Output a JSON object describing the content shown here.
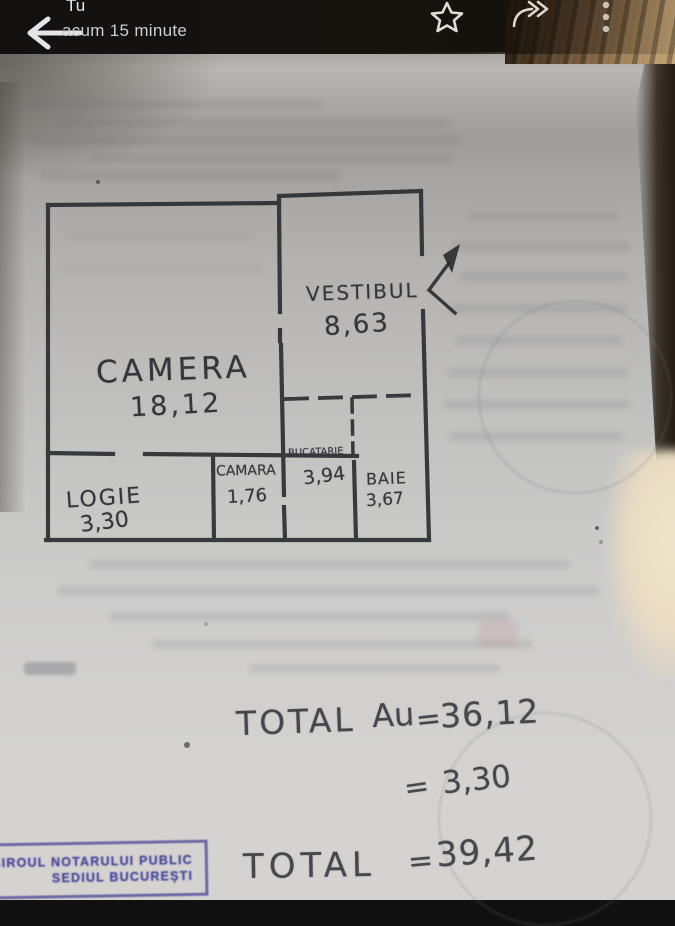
{
  "app_bar": {
    "title": "Tu",
    "subtitle": "acum 15 minute",
    "icons": {
      "back": "back-arrow",
      "star": "star-outline",
      "forward": "forward-share",
      "menu": "overflow-menu"
    }
  },
  "photo": {
    "floor_plan": {
      "rooms": [
        {
          "name": "CAMERA",
          "area": "18,12"
        },
        {
          "name": "VESTIBUL",
          "area": "8,63"
        },
        {
          "name": "LOGIE",
          "area": "3,30"
        },
        {
          "name": "CAMARA",
          "area": "1,76"
        },
        {
          "name": "BUCATARIE",
          "area": "3,94"
        },
        {
          "name": "BAIE",
          "area": "3,67"
        }
      ]
    },
    "totals": {
      "row1": {
        "label": "TOTAL",
        "symbol": "Au",
        "eq": "=",
        "value": "36,12"
      },
      "row2": {
        "eq": "=",
        "value": "3,30"
      },
      "row3": {
        "label": "TOTAL",
        "eq": "=",
        "value": "39,42"
      }
    },
    "stamp": {
      "line1": "BIROUL NOTARULUI PUBLIC",
      "line2": "SEDIUL BUCUREȘTI"
    }
  },
  "colors": {
    "pencil": "#35363a",
    "stamp_ink": "#43439b",
    "app_bar_bg": "#141210"
  }
}
